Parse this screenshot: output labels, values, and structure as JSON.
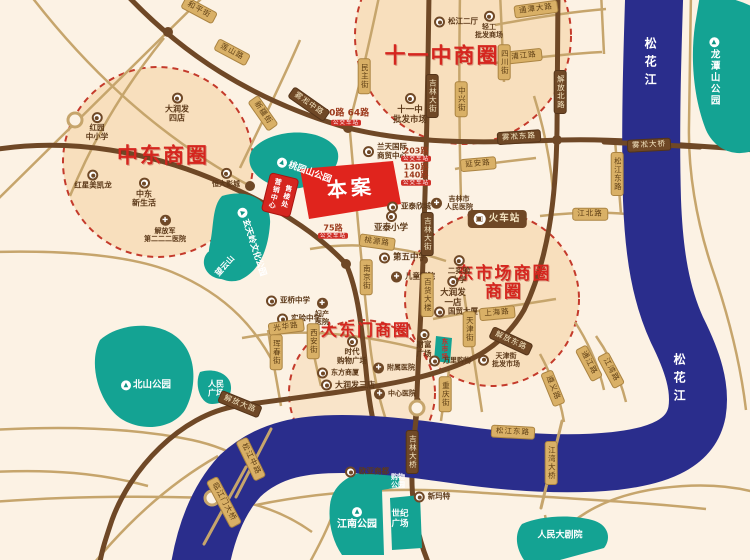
{
  "canvas": {
    "width": 750,
    "height": 560
  },
  "colors": {
    "background": "#fcf2e4",
    "river": "#2a2d8c",
    "park": "#14a393",
    "road_thin": "#c6a56c",
    "road_dark": "#6f4826",
    "district_fill": "#f6d9b3",
    "district_stroke": "#c43a2b",
    "accent_red": "#d5261f",
    "tag_tan": "#d9b066",
    "bus_tag": "#cf2f27"
  },
  "districts": [
    "中东商圈",
    "十一中商圈",
    "大东门商圈",
    "东市场商圈"
  ],
  "site": {
    "name": "本案",
    "sales_tag": "售楼处 营销中心"
  },
  "river_name": "松花江",
  "labels": [
    {
      "t": "title",
      "text": "中东商圈",
      "x": 163,
      "y": 156,
      "fs": 21
    },
    {
      "t": "title",
      "text": "十一中商圈",
      "x": 442,
      "y": 56,
      "fs": 21
    },
    {
      "t": "title",
      "text": "大东门商圈",
      "x": 366,
      "y": 331,
      "fs": 16
    },
    {
      "t": "title",
      "text": "东市场商圈\n",
      "x": 504,
      "y": 274,
      "fs": 17
    },
    {
      "t": "title",
      "text": "商圈",
      "x": 504,
      "y": 292,
      "fs": 17
    },
    {
      "t": "case",
      "text": "本案",
      "x": 351,
      "y": 189,
      "fs": 20,
      "rot": -5
    },
    {
      "t": "sales",
      "text": "售楼处\n营销中心",
      "x": 280,
      "y": 195,
      "rot": 14
    },
    {
      "t": "station",
      "text": "火车站",
      "x": 497,
      "y": 219
    },
    {
      "t": "water",
      "text": "松花江",
      "x": 650,
      "y": 64
    },
    {
      "t": "water",
      "text": "松花江",
      "x": 679,
      "y": 380
    },
    {
      "t": "parkv",
      "text": "龙潭山公园",
      "x": 714,
      "y": 72,
      "fs": 9.5
    },
    {
      "t": "park",
      "text": "桃园山公园",
      "x": 304,
      "y": 171,
      "fs": 9,
      "rot": 20
    },
    {
      "t": "park",
      "text": "玄天岭文化公园",
      "x": 252,
      "y": 242,
      "fs": 8.5,
      "rot": 72
    },
    {
      "t": "parkm",
      "text": "望云山",
      "x": 225,
      "y": 266,
      "fs": 8,
      "rot": -48
    },
    {
      "t": "park",
      "text": "北山公园",
      "x": 146,
      "y": 385,
      "fs": 9.5
    },
    {
      "t": "parkm",
      "text": "人民\n广场",
      "x": 216,
      "y": 389,
      "fs": 8
    },
    {
      "t": "parki",
      "text": "江南公园",
      "x": 357,
      "y": 519,
      "fs": 10
    },
    {
      "t": "parkm",
      "text": "世纪\n广场",
      "x": 400,
      "y": 519,
      "fs": 8.5
    },
    {
      "t": "parkm",
      "text": "购物\n公园",
      "x": 398,
      "y": 481,
      "fs": 7
    },
    {
      "t": "parkm",
      "text": "人民大剧院",
      "x": 560,
      "y": 536,
      "fs": 9
    },
    {
      "t": "tealtag",
      "text": "东市场",
      "x": 443,
      "y": 349,
      "fs": 6.5
    },
    {
      "t": "poi",
      "text": "红园\n中小学",
      "x": 97,
      "y": 127,
      "fs": 7.5
    },
    {
      "t": "poi",
      "text": "大润发\n四店",
      "x": 177,
      "y": 108,
      "fs": 8
    },
    {
      "t": "poi",
      "text": "红星美凯龙",
      "x": 93,
      "y": 180,
      "fs": 7.5
    },
    {
      "t": "poi",
      "text": "中东\n新生活",
      "x": 144,
      "y": 193,
      "fs": 8
    },
    {
      "t": "poi",
      "text": "恒大影城",
      "x": 226,
      "y": 178,
      "fs": 7
    },
    {
      "t": "hosp",
      "text": "解放军\n第二二二医院",
      "x": 165,
      "y": 229,
      "fs": 7
    },
    {
      "t": "poil",
      "text": "松江二厅",
      "x": 456,
      "y": 22,
      "fs": 7.5
    },
    {
      "t": "poi",
      "text": "轻工\n批发商场",
      "x": 489,
      "y": 25,
      "fs": 7
    },
    {
      "t": "poi",
      "text": "十一中\n批发市场",
      "x": 410,
      "y": 109,
      "fs": 8.5
    },
    {
      "t": "poil",
      "text": "兰天国际\n商贸中心",
      "x": 385,
      "y": 152,
      "fs": 7.5
    },
    {
      "t": "poil",
      "text": "亚泰欣城",
      "x": 409,
      "y": 207,
      "fs": 7.5
    },
    {
      "t": "poi",
      "text": "亚泰小学",
      "x": 391,
      "y": 222,
      "fs": 8.5
    },
    {
      "t": "poil",
      "text": "第五中学",
      "x": 403,
      "y": 258,
      "fs": 8.5
    },
    {
      "t": "hospl",
      "text": "儿童医院",
      "x": 413,
      "y": 277,
      "fs": 7.5
    },
    {
      "t": "hospl",
      "text": "吉林市\n人民医院",
      "x": 452,
      "y": 203,
      "fs": 7
    },
    {
      "t": "poi",
      "text": "二实验\n小学",
      "x": 459,
      "y": 270,
      "fs": 7.5
    },
    {
      "t": "poi",
      "text": "大润发\n一店",
      "x": 453,
      "y": 292,
      "fs": 8.5
    },
    {
      "t": "poil",
      "text": "国贸大厦",
      "x": 456,
      "y": 312,
      "fs": 7.5
    },
    {
      "t": "poi",
      "text": "财富\n广场",
      "x": 424,
      "y": 344,
      "fs": 7.5
    },
    {
      "t": "poil",
      "text": "万里购物",
      "x": 450,
      "y": 361,
      "fs": 7
    },
    {
      "t": "poil",
      "text": "天津街\n批发市场",
      "x": 499,
      "y": 360,
      "fs": 7
    },
    {
      "t": "poi",
      "text": "时代\n购物广场",
      "x": 352,
      "y": 351,
      "fs": 7.5
    },
    {
      "t": "poil",
      "text": "东方商厦",
      "x": 338,
      "y": 373,
      "fs": 7
    },
    {
      "t": "poil",
      "text": "大润发三店",
      "x": 348,
      "y": 385,
      "fs": 8
    },
    {
      "t": "hospl",
      "text": "附属医院",
      "x": 394,
      "y": 368,
      "fs": 7
    },
    {
      "t": "hospl",
      "text": "中心医院",
      "x": 395,
      "y": 394,
      "fs": 7
    },
    {
      "t": "hosp",
      "text": "妇产\n医院",
      "x": 322,
      "y": 312,
      "fs": 7
    },
    {
      "t": "poil",
      "text": "亚桥中学",
      "x": 288,
      "y": 301,
      "fs": 7.5
    },
    {
      "t": "poil",
      "text": "实验中学",
      "x": 299,
      "y": 319,
      "fs": 7.5
    },
    {
      "t": "poil",
      "text": "欧亚商都",
      "x": 367,
      "y": 472,
      "fs": 7.5
    },
    {
      "t": "poil",
      "text": "新玛特",
      "x": 432,
      "y": 497,
      "fs": 7.5
    },
    {
      "t": "bus",
      "text": "50路 64路",
      "x": 346,
      "y": 114,
      "fs": 9
    },
    {
      "t": "btag",
      "text": "公交车站",
      "x": 346,
      "y": 123
    },
    {
      "t": "bus",
      "text": "203路",
      "x": 416,
      "y": 151,
      "fs": 8
    },
    {
      "t": "btag",
      "text": "公交车站",
      "x": 416,
      "y": 159
    },
    {
      "t": "bus",
      "text": "130路",
      "x": 416,
      "y": 167,
      "fs": 8
    },
    {
      "t": "bus",
      "text": "140路",
      "x": 416,
      "y": 175,
      "fs": 8
    },
    {
      "t": "btag",
      "text": "公交车站",
      "x": 416,
      "y": 183
    },
    {
      "t": "bus",
      "text": "75路",
      "x": 333,
      "y": 228,
      "fs": 8
    },
    {
      "t": "btag",
      "text": "公交车站",
      "x": 333,
      "y": 236
    },
    {
      "t": "rt",
      "text": "通潭大路",
      "x": 536,
      "y": 9,
      "rot": -8
    },
    {
      "t": "rt",
      "text": "浦江路",
      "x": 524,
      "y": 56,
      "rot": -6
    },
    {
      "t": "rt",
      "text": "四川街",
      "x": 504,
      "y": 62,
      "v": 1
    },
    {
      "t": "rt",
      "text": "中兴街",
      "x": 461,
      "y": 99,
      "v": 1
    },
    {
      "t": "rt",
      "text": "民主街",
      "x": 364,
      "y": 76,
      "v": 1
    },
    {
      "t": "rt",
      "text": "延安路",
      "x": 478,
      "y": 164,
      "rot": -5
    },
    {
      "t": "rt",
      "text": "松江东路",
      "x": 617,
      "y": 174,
      "v": 1
    },
    {
      "t": "rt",
      "text": "江北路",
      "x": 590,
      "y": 214
    },
    {
      "t": "rt",
      "text": "和平街",
      "x": 199,
      "y": 10,
      "rot": 28
    },
    {
      "t": "rt",
      "text": "莲山路",
      "x": 232,
      "y": 52,
      "rot": 28
    },
    {
      "t": "rt",
      "text": "新疆街",
      "x": 263,
      "y": 113,
      "rot": 55
    },
    {
      "t": "rt",
      "text": "南京街",
      "x": 366,
      "y": 277,
      "v": 1
    },
    {
      "t": "rt",
      "text": "桃源路",
      "x": 377,
      "y": 242,
      "rot": 8
    },
    {
      "t": "rt",
      "text": "光华路",
      "x": 286,
      "y": 327,
      "rot": -8
    },
    {
      "t": "rt",
      "text": "西安街",
      "x": 313,
      "y": 341,
      "v": 1
    },
    {
      "t": "rt",
      "text": "珲春街",
      "x": 276,
      "y": 352,
      "v": 1
    },
    {
      "t": "rt",
      "text": "上海路",
      "x": 497,
      "y": 313,
      "rot": -5
    },
    {
      "t": "rt",
      "text": "天津街",
      "x": 469,
      "y": 329,
      "v": 1
    },
    {
      "t": "rt",
      "text": "百货大楼",
      "x": 427,
      "y": 295,
      "v": 1
    },
    {
      "t": "rt",
      "text": "重庆街",
      "x": 445,
      "y": 394,
      "v": 1
    },
    {
      "t": "rt",
      "text": "松江中路",
      "x": 251,
      "y": 459,
      "rot": 64
    },
    {
      "t": "rt",
      "text": "临江门大桥",
      "x": 224,
      "y": 502,
      "rot": 62
    },
    {
      "t": "rt",
      "text": "江湾大桥",
      "x": 551,
      "y": 463,
      "v": 1
    },
    {
      "t": "rt",
      "text": "松江东路",
      "x": 513,
      "y": 432,
      "rot": 3
    },
    {
      "t": "rt",
      "text": "通江路",
      "x": 589,
      "y": 363,
      "rot": 62
    },
    {
      "t": "rt",
      "text": "江湾路",
      "x": 611,
      "y": 370,
      "rot": 62
    },
    {
      "t": "rt",
      "text": "遵义路",
      "x": 553,
      "y": 388,
      "rot": 68
    },
    {
      "t": "rd",
      "text": "雾凇中路",
      "x": 309,
      "y": 104,
      "rot": 35
    },
    {
      "t": "rd",
      "text": "雾凇东路",
      "x": 519,
      "y": 137,
      "rot": -4
    },
    {
      "t": "rd",
      "text": "雾凇大桥",
      "x": 649,
      "y": 145,
      "rot": -3
    },
    {
      "t": "rd",
      "text": "解放北路",
      "x": 560,
      "y": 92,
      "v": 1
    },
    {
      "t": "rd",
      "text": "吉林大街",
      "x": 432,
      "y": 96,
      "v": 1
    },
    {
      "t": "rd",
      "text": "吉林大街",
      "x": 427,
      "y": 234,
      "v": 1
    },
    {
      "t": "rd",
      "text": "解放东路",
      "x": 511,
      "y": 341,
      "rot": 25
    },
    {
      "t": "rd",
      "text": "解放大路",
      "x": 240,
      "y": 404,
      "rot": 22
    },
    {
      "t": "rd",
      "text": "吉林大桥",
      "x": 412,
      "y": 452,
      "v": 1
    }
  ]
}
